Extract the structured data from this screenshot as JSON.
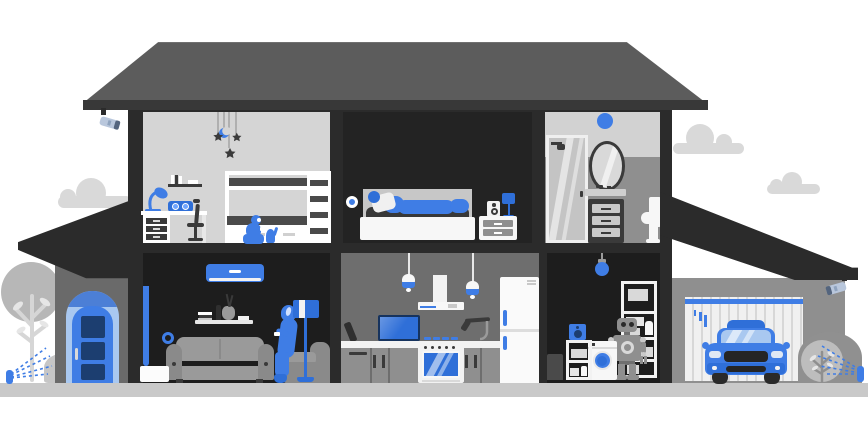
{
  "meta": {
    "kind": "illustration",
    "subject": "smart-home-house-cutaway"
  },
  "colors": {
    "blue": "#3F7DE5",
    "blueMid": "#2F6FD8",
    "navy": "#1C3E70",
    "blueLight": "#A9C8F0",
    "blueArch": "#4C7FD6",
    "white": "#FFFFFF",
    "offWhite": "#F2F2F2",
    "roof": "#5C5C5C",
    "eave": "#383838",
    "frame": "#2B2B2B",
    "roomDark": "#1D1D1D",
    "bedroomWall": "#232323",
    "kidsWall": "#D5D5D5",
    "kitchenWall": "#6E6E6E",
    "bathUpper": "#D2D2D2",
    "bathLower": "#8F8F8F",
    "garageWall": "#8F8F8F",
    "doorFill": "#F0F0F0",
    "ground": "#C9C9C9",
    "cloud": "#D9D9D9",
    "tree": "#B7B7B7",
    "treeLight": "#D6D6D6",
    "bushDark": "#909090",
    "bushLight": "#C6C6C6",
    "couch": "#9A9A9A",
    "chairGray": "#8A8A8A",
    "itemDark": "#3A3A3A",
    "panelGray": "#C7C7C7",
    "robotGray": "#8F8F8F",
    "camBody": "#B9C7DC"
  },
  "scene": {
    "floors": [
      {
        "name": "upper",
        "rooms": [
          {
            "id": "kids-room",
            "objects": [
              "star-mobile",
              "wall-shelf",
              "desk-lamp",
              "smart-radio",
              "desk",
              "drawer-unit",
              "office-chair",
              "bunk-bed",
              "child-with-phone",
              "cat"
            ]
          },
          {
            "id": "bedroom",
            "objects": [
              "smart-sensor",
              "bed",
              "sleeping-person",
              "nightstand",
              "speaker",
              "table-lamp"
            ]
          },
          {
            "id": "bathroom",
            "objects": [
              "smart-light",
              "shower",
              "mirror",
              "vanity",
              "toilet"
            ]
          }
        ]
      },
      {
        "name": "ground",
        "rooms": [
          {
            "id": "living-room",
            "objects": [
              "air-conditioner",
              "curtain",
              "smart-thermostat",
              "wall-shelf",
              "sofa",
              "woman-with-phone",
              "armchair",
              "floor-lamp",
              "side-table"
            ]
          },
          {
            "id": "kitchen",
            "objects": [
              "pendant-light",
              "pendant-light",
              "range-hood",
              "tv",
              "counter",
              "burners",
              "faucet",
              "cabinets",
              "oven",
              "fridge"
            ]
          },
          {
            "id": "utility-room",
            "objects": [
              "smart-bulb",
              "storage-shelf",
              "robot",
              "washing-machine",
              "speaker-shelf",
              "bin"
            ]
          },
          {
            "id": "garage",
            "objects": [
              "garage-door",
              "car",
              "security-camera"
            ]
          }
        ]
      }
    ],
    "exterior": [
      "roof",
      "porch-roof",
      "front-door",
      "security-camera-left",
      "security-camera-right",
      "tree",
      "bushes-left",
      "bushes-right",
      "sprinkler-left",
      "sprinkler-right",
      "clouds",
      "ground-strip"
    ]
  }
}
